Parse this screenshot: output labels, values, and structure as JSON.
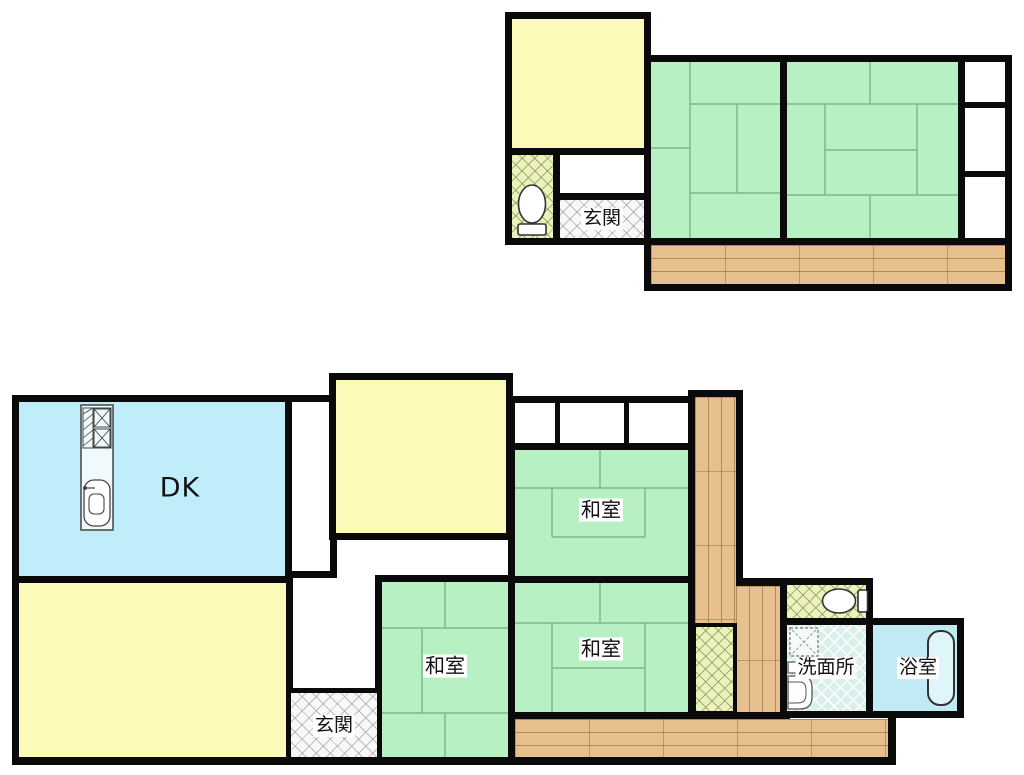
{
  "title": "Japanese two-storey house floor plan",
  "labels": {
    "dk": "DK",
    "washitsu": "和室",
    "genkan": "玄関",
    "senmenjo": "洗面所",
    "yokushitsu": "浴室"
  },
  "floors": {
    "second_floor": {
      "rooms": [
        {
          "name": "western-room",
          "fill": "yellow"
        },
        {
          "name": "toilet",
          "fill": "hatch-olive",
          "icon": "toilet-icon"
        },
        {
          "name": "hall-nook",
          "fill": "white"
        },
        {
          "name": "genkan-hall",
          "fill": "hatch-gray",
          "label": "玄関"
        },
        {
          "name": "tatami-room-left",
          "fill": "tatami-green"
        },
        {
          "name": "tatami-room-right",
          "fill": "tatami-green"
        },
        {
          "name": "closet-column",
          "fill": "white",
          "cells": 3
        },
        {
          "name": "engawa-veranda",
          "fill": "wood"
        }
      ]
    },
    "first_floor": {
      "rooms": [
        {
          "name": "dining-kitchen",
          "fill": "cyan",
          "label": "DK",
          "icon": "kitchen-unit-icon"
        },
        {
          "name": "western-room-southwest",
          "fill": "yellow"
        },
        {
          "name": "western-room-center",
          "fill": "yellow"
        },
        {
          "name": "hall-strip",
          "fill": "white"
        },
        {
          "name": "closet-row",
          "fill": "white",
          "cells": 3
        },
        {
          "name": "washitsu-northeast",
          "fill": "tatami-green",
          "label": "和室"
        },
        {
          "name": "washitsu-southeast",
          "fill": "tatami-green",
          "label": "和室"
        },
        {
          "name": "washitsu-southwest",
          "fill": "tatami-green",
          "label": "和室"
        },
        {
          "name": "genkan",
          "fill": "hatch-gray",
          "label": "玄関"
        },
        {
          "name": "corridor",
          "fill": "wood"
        },
        {
          "name": "storage-hatch",
          "fill": "hatch-olive"
        },
        {
          "name": "toilet",
          "fill": "hatch-olive",
          "icon": "toilet-icon"
        },
        {
          "name": "senmenjo-washroom",
          "fill": "tile-cyan",
          "label": "洗面所",
          "icons": [
            "washing-machine-icon",
            "sink-icon"
          ]
        },
        {
          "name": "bathroom",
          "fill": "bath-blue",
          "label": "浴室",
          "icon": "bathtub-icon"
        },
        {
          "name": "engawa-veranda",
          "fill": "wood"
        }
      ]
    }
  },
  "colors": {
    "wall": "#0a0a0a",
    "tatami_green": "#b7f0c2",
    "room_yellow": "#fcfab8",
    "dk_cyan": "#bfedf9",
    "bath_blue": "#c2eaf4",
    "wood": "#e6c08f",
    "toilet_hatch": "#ecf3ba",
    "genkan_hatch": "#f8f8f6",
    "washroom_tile": "#d9efe9",
    "background": "#ffffff"
  }
}
